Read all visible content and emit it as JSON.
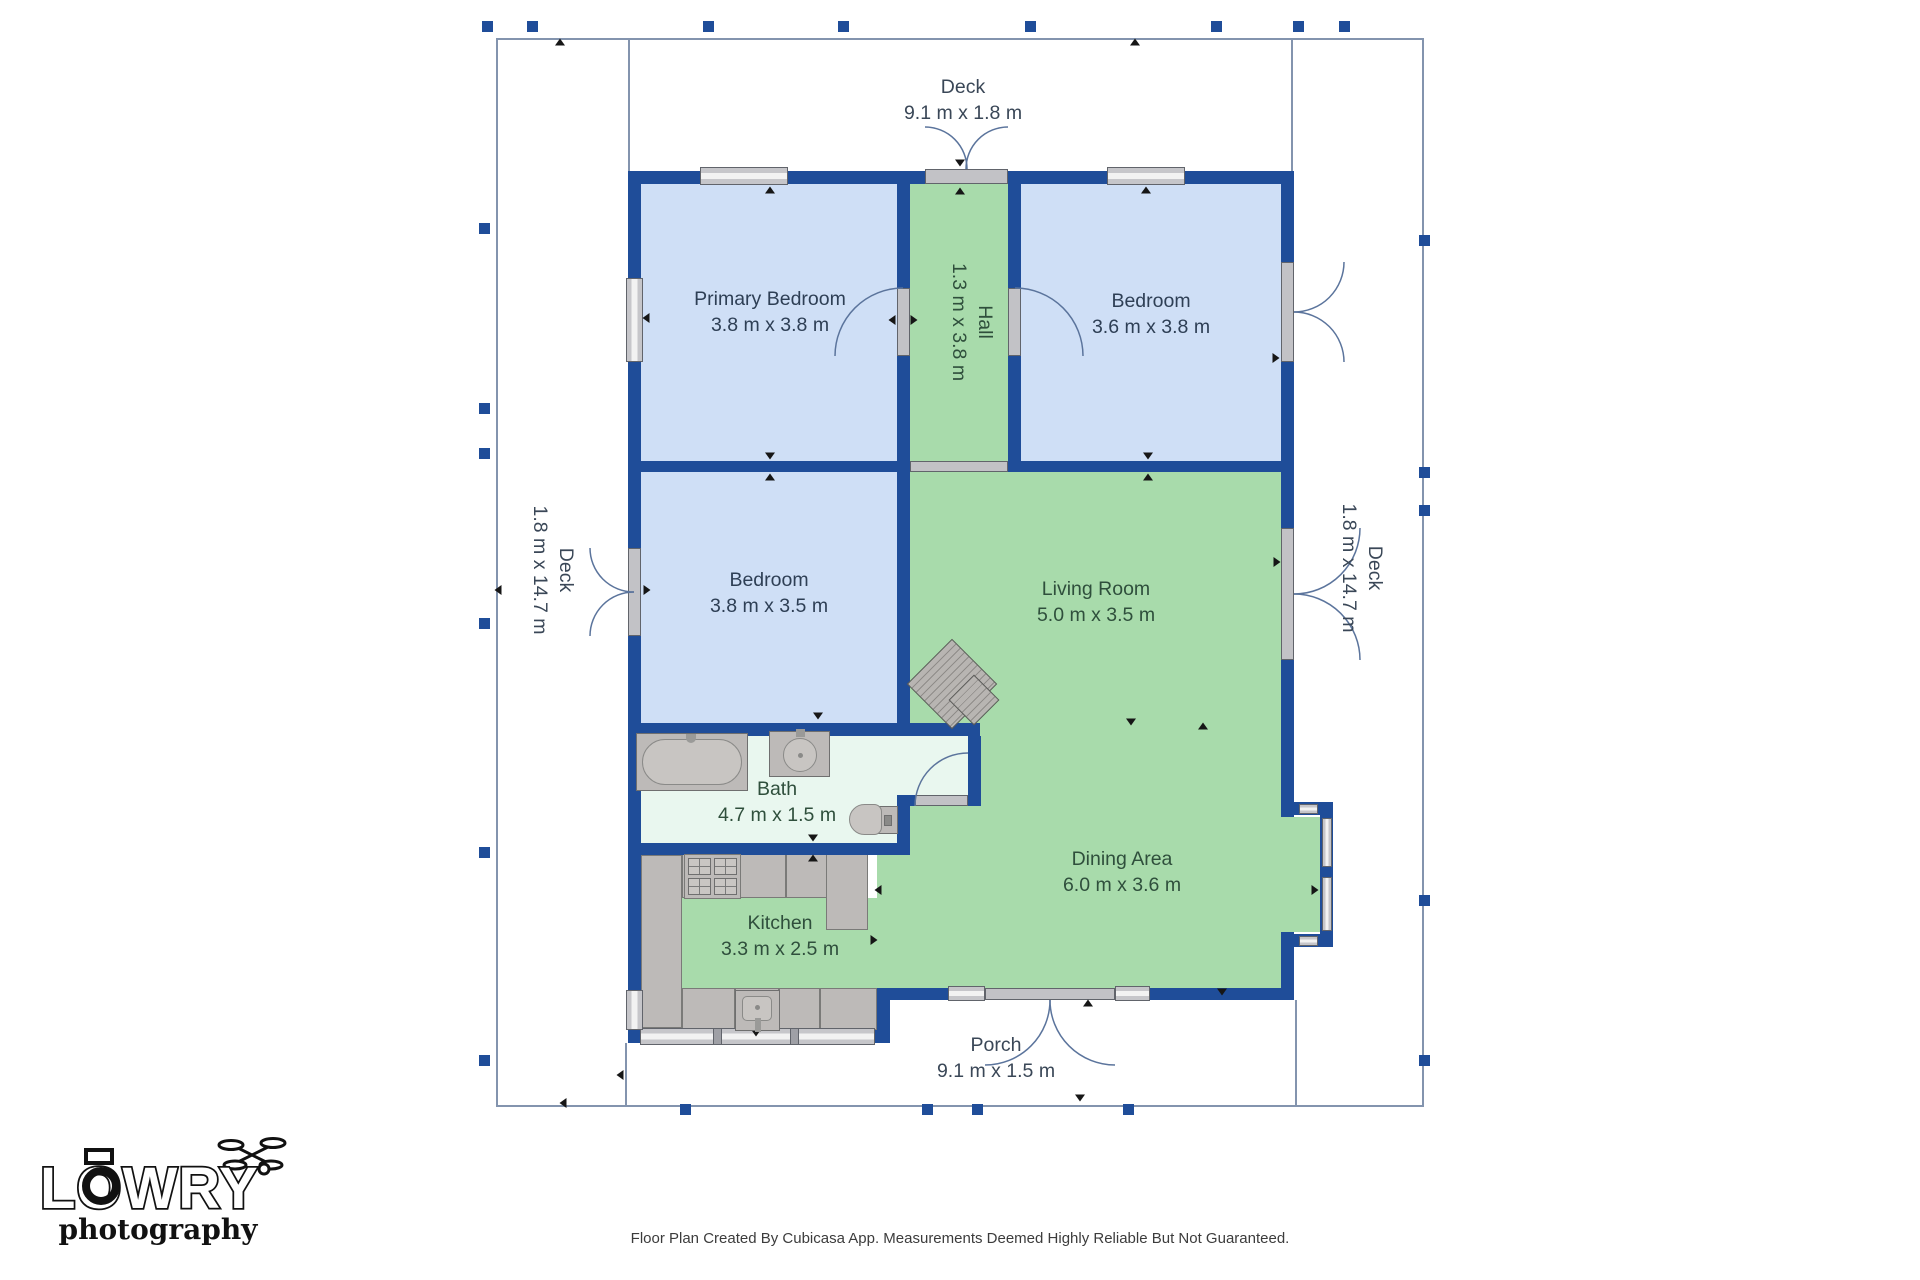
{
  "title": "Floor Plan",
  "rooms": [
    {
      "id": "primary-bedroom",
      "name": "Primary Bedroom",
      "dims": "3.8 m x 3.8 m"
    },
    {
      "id": "bedroom-top-right",
      "name": "Bedroom",
      "dims": "3.6 m x 3.8 m"
    },
    {
      "id": "bedroom-middle",
      "name": "Bedroom",
      "dims": "3.8 m x 3.5 m"
    },
    {
      "id": "hall",
      "name": "Hall",
      "dims": "1.3 m x 3.8 m"
    },
    {
      "id": "living-room",
      "name": "Living Room",
      "dims": "5.0 m x 3.5 m"
    },
    {
      "id": "dining-area",
      "name": "Dining Area",
      "dims": "6.0 m x 3.6 m"
    },
    {
      "id": "kitchen",
      "name": "Kitchen",
      "dims": "3.3 m x 2.5 m"
    },
    {
      "id": "bath",
      "name": "Bath",
      "dims": "4.7 m x 1.5 m"
    },
    {
      "id": "deck-top",
      "name": "Deck",
      "dims": "9.1 m x 1.8 m"
    },
    {
      "id": "deck-left",
      "name": "Deck",
      "dims": "1.8 m x 14.7 m"
    },
    {
      "id": "deck-right",
      "name": "Deck",
      "dims": "1.8 m x 14.7 m"
    },
    {
      "id": "porch",
      "name": "Porch",
      "dims": "9.1 m x 1.5 m"
    }
  ],
  "logo": {
    "word": "LOWRY",
    "sub": "photography"
  },
  "footer": {
    "disclaimer": "Floor Plan Created By Cubicasa App. Measurements Deemed Highly Reliable But Not Guaranteed."
  },
  "colors": {
    "wall": "#1f4d99",
    "bedroom": "#cfdff6",
    "living": "#a8dbab",
    "bath": "#e9f7ef",
    "window": "#c6c6ca",
    "deck_line": "#8394ae",
    "label_blue": "#2e3f55",
    "label_green": "#2f4f3c",
    "label_deck": "#3a4757",
    "arrow": "#161616",
    "footer_text": "#3c3c3c"
  }
}
